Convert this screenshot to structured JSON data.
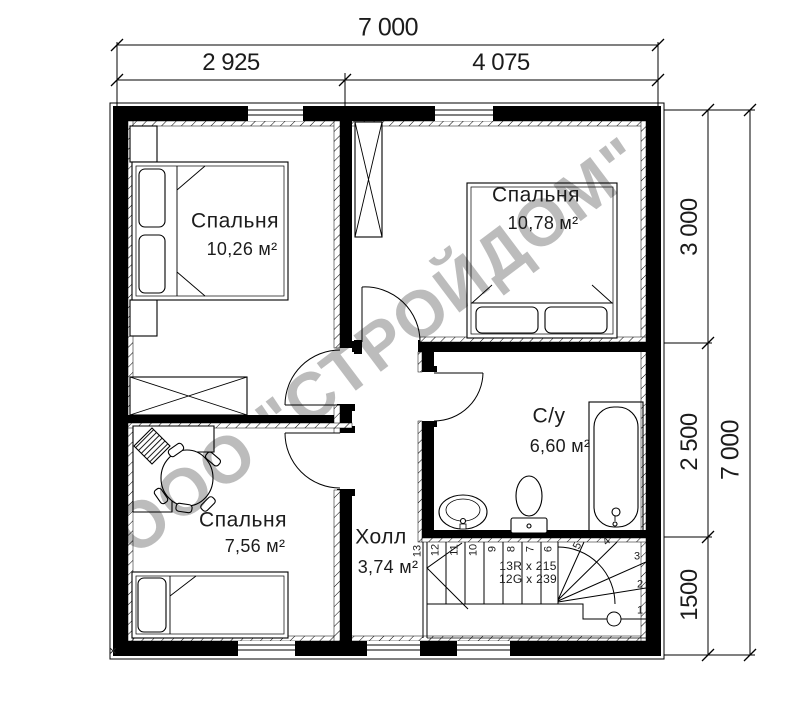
{
  "watermark": "ООО \"СТРОЙДОМ\"",
  "dimensions": {
    "top": {
      "total": "7 000",
      "left_segment": "2 925",
      "right_segment": "4 075"
    },
    "right": {
      "total": "7 000",
      "top_segment": "3 000",
      "middle_segment": "2 500",
      "bottom_segment": "1500"
    }
  },
  "rooms": {
    "bedroom_top_left": {
      "name": "Спальня",
      "area": "10,26 м²"
    },
    "bedroom_top_right": {
      "name": "Спальня",
      "area": "10,78 м²"
    },
    "bedroom_bottom_left": {
      "name": "Спальня",
      "area": "7,56 м²"
    },
    "bathroom": {
      "name": "С/у",
      "area": "6,60 м²"
    },
    "hall": {
      "name": "Холл",
      "area": "3,74 м²"
    }
  },
  "stairs": {
    "risers_note": "13R x 215",
    "goings_note": "12G x 239",
    "step_numbers": [
      "1",
      "2",
      "3",
      "4",
      "5",
      "6",
      "7",
      "8",
      "9",
      "10",
      "11",
      "12",
      "13"
    ]
  },
  "corner_mark": "✕"
}
